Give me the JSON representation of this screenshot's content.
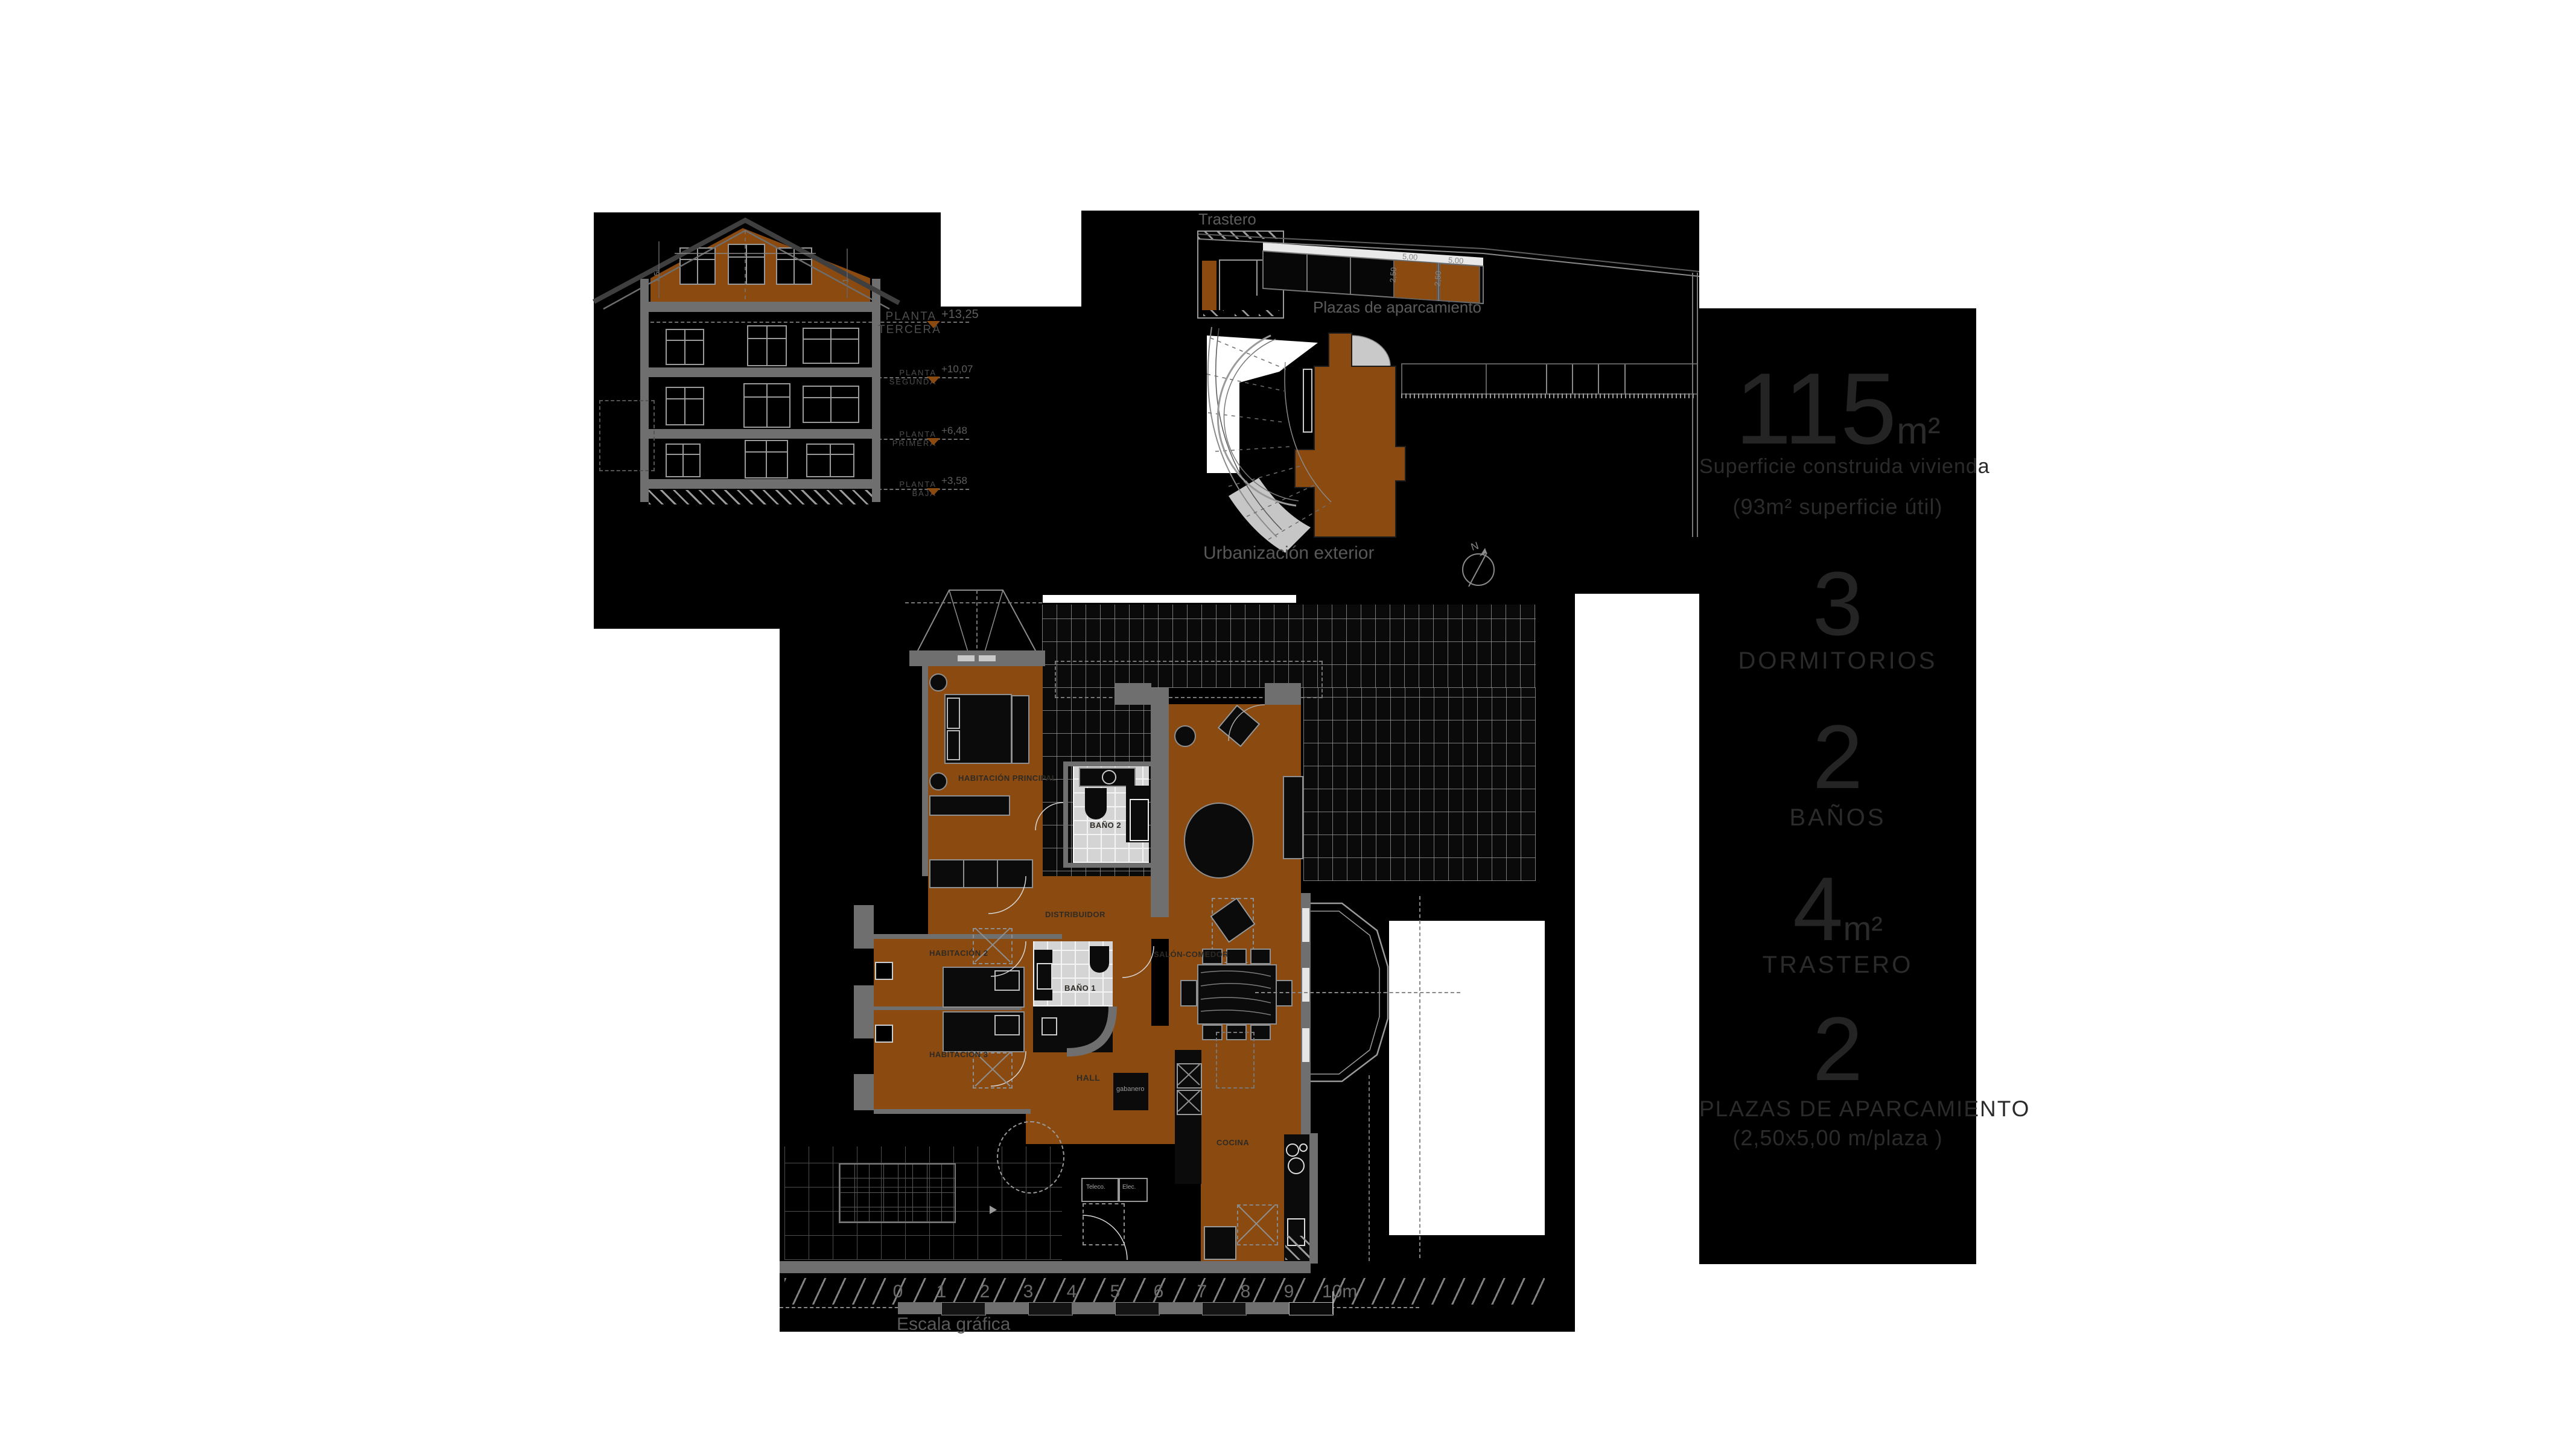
{
  "colors": {
    "accent": "#8a4a10",
    "panel": "#000000",
    "page": "#ffffff"
  },
  "stats": {
    "area_value": "115",
    "area_unit": "m²",
    "area_line1": "Superficie construida vivienda",
    "area_line2": "(93m² superficie útil)",
    "bedrooms_value": "3",
    "bedrooms_label": "DORMITORIOS",
    "baths_value": "2",
    "baths_label": "BAÑOS",
    "storage_value": "4",
    "storage_unit": "m²",
    "storage_label": "TRASTERO",
    "parking_value": "2",
    "parking_label": "PLAZAS DE APARCAMIENTO",
    "parking_sub": "(2,50x5,00 m/plaza )"
  },
  "elevation": {
    "levels": [
      {
        "label": "PLANTA TERCERA",
        "value": "+13,25"
      },
      {
        "label": "PLANTA SEGUNDA",
        "value": "+10,07"
      },
      {
        "label": "PLANTA PRIMERA",
        "value": "+6,48"
      },
      {
        "label": "PLANTA BAJA",
        "value": "+3,58"
      }
    ],
    "dim_left": "1,50",
    "dim_right": "1,9"
  },
  "site": {
    "trastero": "Trastero",
    "parking": "Plazas de aparcamiento",
    "urbanizacion": "Urbanización exterior",
    "north": "N",
    "bay_length": "5,00",
    "bay_width": "2,50"
  },
  "plan": {
    "rooms": [
      "HABITACIÓN PRINCIPAL",
      "BAÑO 2",
      "DISTRIBUIDOR",
      "HABITACIÓN 2",
      "HABITACIÓN 3",
      "BAÑO 1",
      "HALL",
      "SALÓN-COMEDOR",
      "COCINA"
    ],
    "closet": "gabanero",
    "box1": "Teleco.",
    "box2": "Elec.",
    "scale_label": "Escala gráfica",
    "ticks": [
      "0",
      "1",
      "2",
      "3",
      "4",
      "5",
      "6",
      "7",
      "8",
      "9",
      "10m"
    ]
  }
}
